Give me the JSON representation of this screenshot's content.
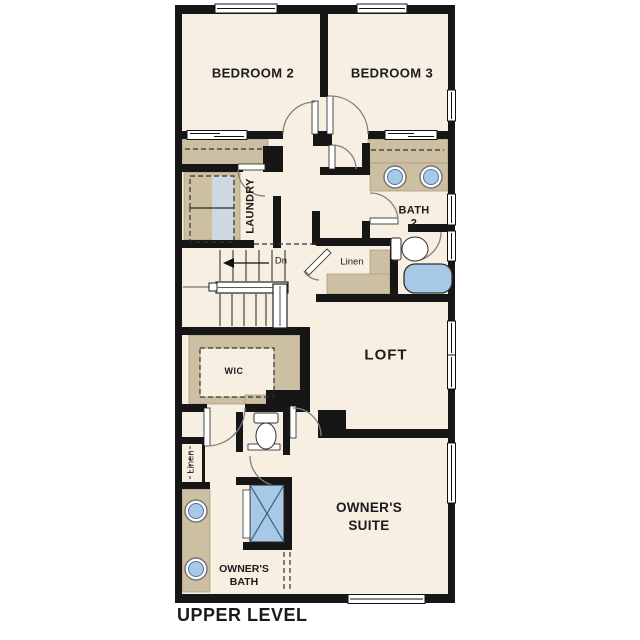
{
  "plan": {
    "level_title": "UPPER LEVEL",
    "rooms": {
      "bedroom2": "BEDROOM 2",
      "bedroom3": "BEDROOM 3",
      "laundry": "LAUNDRY",
      "bath2_line1": "BATH",
      "bath2_line2": "2",
      "linen_center": "Linen",
      "linen_left": "Linen",
      "stairs_direction": "Dn",
      "wic": "WIC",
      "loft": "LOFT",
      "owners_bath_line1": "OWNER'S",
      "owners_bath_line2": "BATH",
      "owners_suite_line1": "OWNER'S",
      "owners_suite_line2": "SUITE"
    },
    "fixtures": [
      "washer-dryer-dashed-outline",
      "bath2-sink",
      "bath2-sink",
      "bath2-toilet",
      "bathtub",
      "owners-bath-sink",
      "owners-bath-sink",
      "owners-toilet",
      "shower",
      "stairs-down-arrow",
      "bedroom-closet-bypass-doors",
      "windows"
    ],
    "colors": {
      "background": "#ffffff",
      "floor_cream": "#f6efe2",
      "casework_tan": "#cdbfa2",
      "fixture_blue": "#a7c9e6",
      "washer_strip_blue": "#cdd8e2",
      "wall_black": "#161616"
    }
  }
}
